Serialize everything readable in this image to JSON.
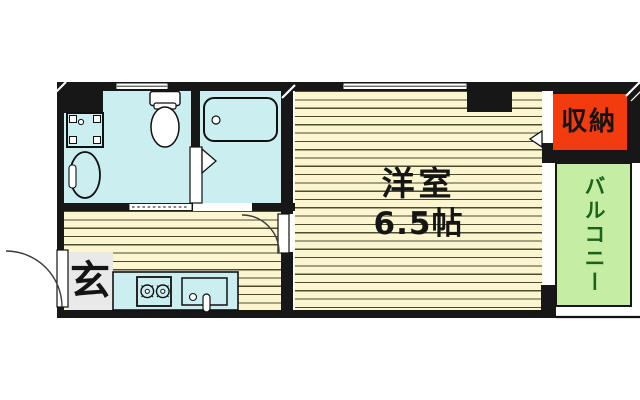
{
  "floorplan": {
    "type": "apartment-madori",
    "labels": {
      "western_room_name": "洋室",
      "western_room_size": "6.5帖",
      "closet": "収納",
      "balcony": "バルコニー",
      "entrance": "玄"
    },
    "rooms": [
      {
        "name": "western-room",
        "label": "洋室 6.5帖",
        "floor": "wood-stripe"
      },
      {
        "name": "kitchen-hall",
        "label": "",
        "floor": "wood-stripe"
      },
      {
        "name": "sanitary-block",
        "label": "",
        "floor": "wet-area",
        "fixtures": [
          "toilet",
          "washing-machine-pan",
          "basin",
          "bathtub"
        ]
      },
      {
        "name": "closet",
        "label": "収納"
      },
      {
        "name": "balcony",
        "label": "バルコニー"
      },
      {
        "name": "entrance",
        "label": "玄"
      }
    ]
  },
  "colors": {
    "wall": "#171717",
    "wet": "#cbeef0",
    "floor": "#fbf6cf",
    "stripe": "#4c4c33",
    "closet_bg": "#f23b0e",
    "balcony_bg": "#c5eda3",
    "balcony_text": "#1c621c",
    "entrance_bg": "#e9e9e9",
    "fixture_white": "#ffffff",
    "outline": "#111111"
  }
}
